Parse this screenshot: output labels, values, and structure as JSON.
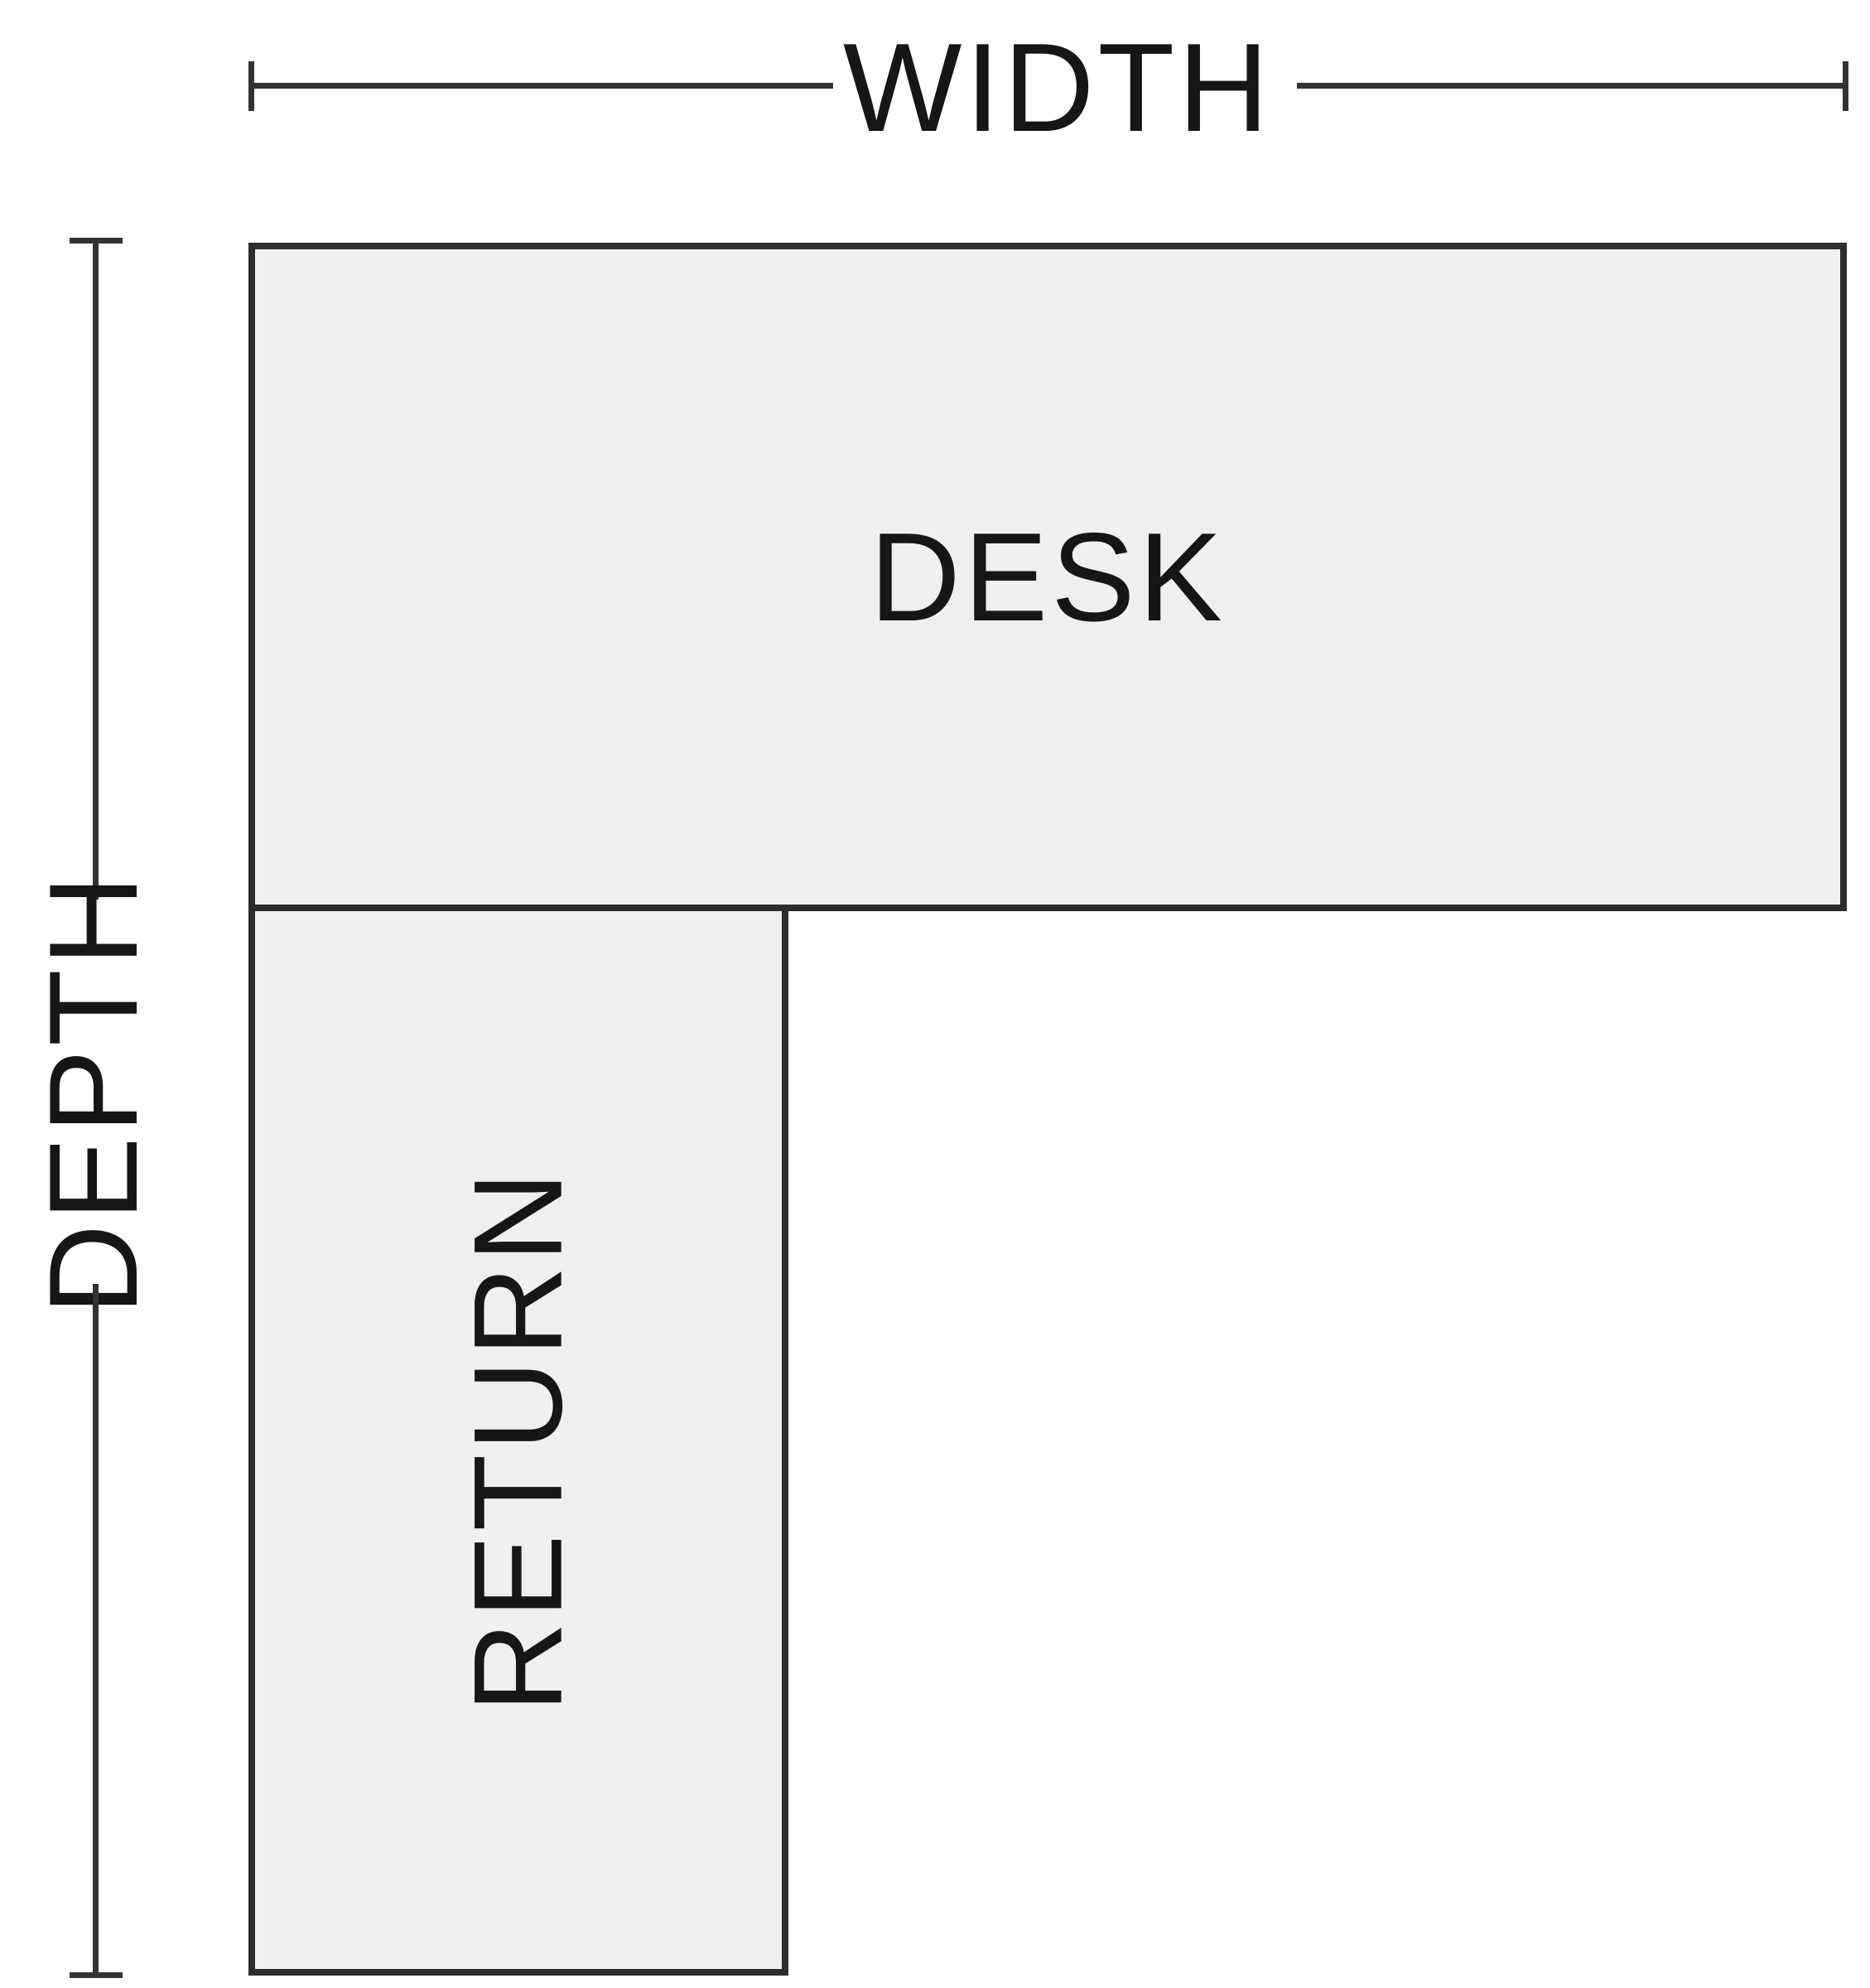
{
  "diagram": {
    "width_dimension": {
      "label": "WIDTH"
    },
    "depth_dimension": {
      "label": "DEPTH"
    },
    "desk": {
      "label": "DESK"
    },
    "return": {
      "label": "RETURN"
    },
    "colors": {
      "background": "#ffffff",
      "surface_fill": "#efefef",
      "outline": "#2d2d2d",
      "dimension_line": "#333333",
      "text": "#161616"
    }
  }
}
